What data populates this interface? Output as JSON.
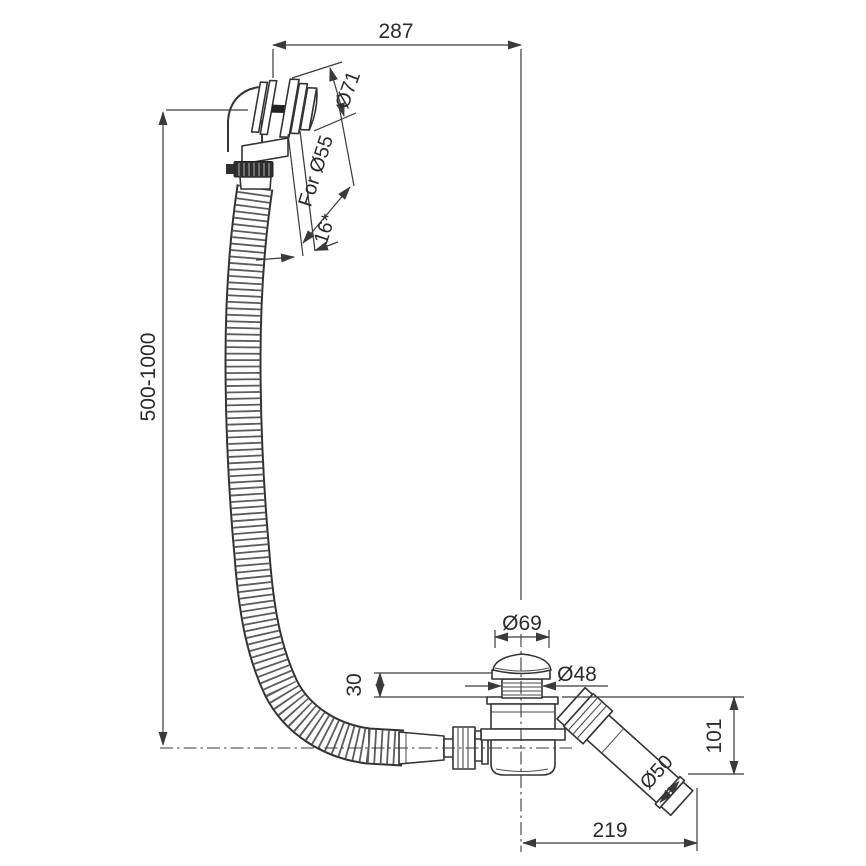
{
  "drawing": {
    "subject": "bath waste and overflow drain kit technical drawing",
    "background_color": "#ffffff",
    "line_color": "#333333",
    "text_color": "#2b2b2b"
  },
  "dims": {
    "width_top": "287",
    "hose_length": "500-1000",
    "face_diameter": "Ø71",
    "hole_note": "For Ø55",
    "angle_note": "16*",
    "cap_diameter": "Ø69",
    "thread_diameter": "Ø48",
    "thread_height": "30",
    "outlet_height": "101",
    "outlet_offset": "219",
    "pipe_diameter": "Ø50"
  }
}
